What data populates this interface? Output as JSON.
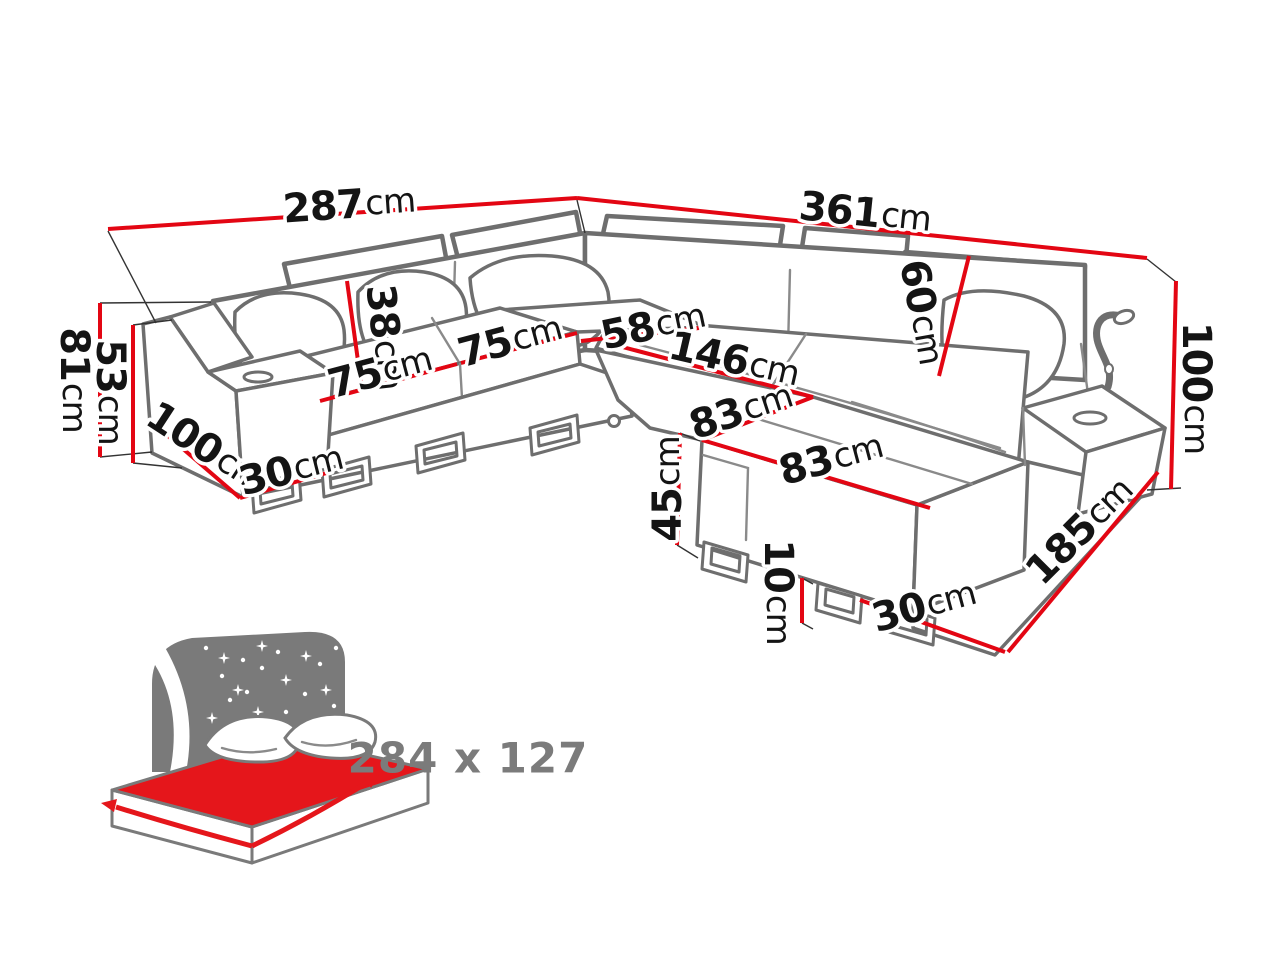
{
  "diagram": {
    "kind": "corner-sofa-bed-dimension-drawing",
    "unit": "cm",
    "colors": {
      "dimension_line": "#e30613",
      "outline": "#6e6e6e",
      "label_text": "#141414",
      "icon_gray": "#7a7a7a",
      "icon_red": "#e5161b",
      "bed_label_text": "#7b7b7b"
    },
    "labels": {
      "width_back_left": {
        "value": "287",
        "unit": "cm"
      },
      "width_back_right": {
        "value": "361",
        "unit": "cm"
      },
      "height_total_left": {
        "value": "81",
        "unit": "cm"
      },
      "height_armrest": {
        "value": "53",
        "unit": "cm"
      },
      "height_back_cushion": {
        "value": "38",
        "unit": "cm"
      },
      "seat_width_first": {
        "value": "75",
        "unit": "cm"
      },
      "seat_width_second": {
        "value": "75",
        "unit": "cm"
      },
      "depth_left_section": {
        "value": "100",
        "unit": "cm"
      },
      "plinth_left": {
        "value": "30",
        "unit": "cm"
      },
      "corner_seat_width": {
        "value": "58",
        "unit": "cm"
      },
      "chaise_length": {
        "value": "146",
        "unit": "cm"
      },
      "ottoman_side_left": {
        "value": "83",
        "unit": "cm"
      },
      "ottoman_side_front": {
        "value": "83",
        "unit": "cm"
      },
      "height_backrest": {
        "value": "60",
        "unit": "cm"
      },
      "height_total_right": {
        "value": "100",
        "unit": "cm"
      },
      "height_ottoman": {
        "value": "45",
        "unit": "cm"
      },
      "height_leg": {
        "value": "10",
        "unit": "cm"
      },
      "length_right_side": {
        "value": "185",
        "unit": "cm"
      },
      "plinth_right": {
        "value": "30",
        "unit": "cm"
      }
    },
    "sleeping_area": {
      "label": "284 x 127",
      "icon": "sofa-bed-night-sleeping-function-icon"
    }
  }
}
